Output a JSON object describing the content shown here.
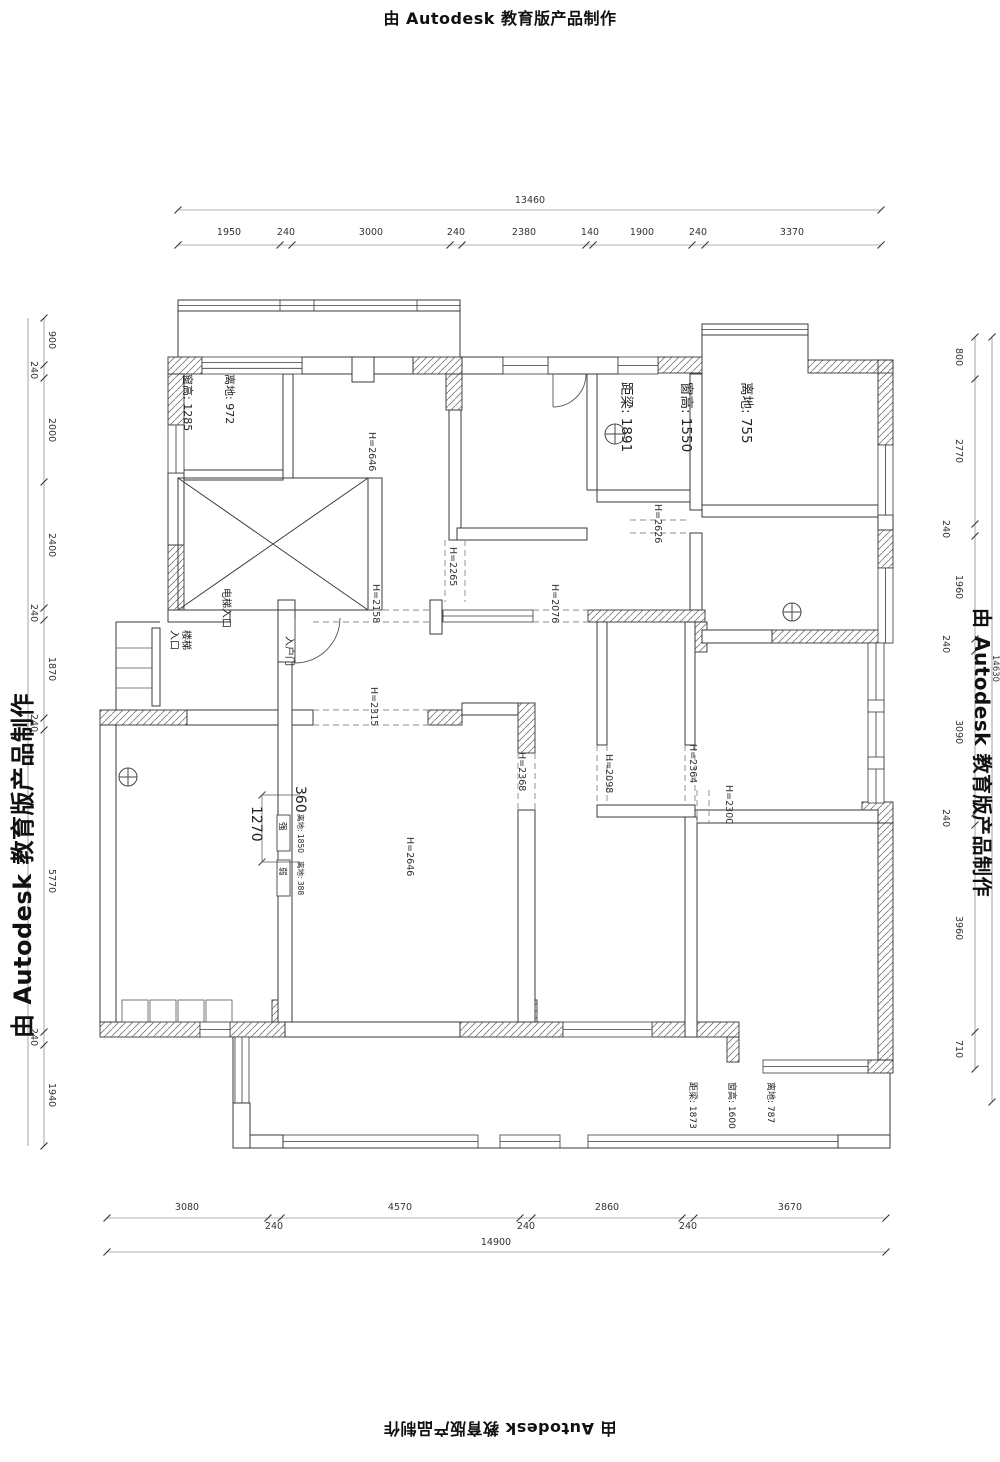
{
  "watermark": {
    "text": "由 Autodesk 教育版产品制作"
  },
  "dims": {
    "top": {
      "total": "13460",
      "segments": [
        "1950",
        "240",
        "3000",
        "240",
        "2380",
        "140",
        "1900",
        "240",
        "3370"
      ]
    },
    "bottom": {
      "total": "14900",
      "row1": [
        "3080",
        "4570",
        "2860",
        "3670"
      ],
      "row2": [
        "240",
        "240",
        "240"
      ]
    },
    "left": {
      "segments": [
        "900",
        "240",
        "2000",
        "2400",
        "240",
        "1870",
        "240",
        "5770",
        "240",
        "1940"
      ]
    },
    "right": {
      "total": "14630",
      "segments": [
        "800",
        "2770",
        "240",
        "1960",
        "240",
        "3090",
        "240",
        "3960",
        "710"
      ]
    },
    "wall_dim_360": "360",
    "wall_dim_1270": "1270"
  },
  "heights": {
    "top_room": "H=2646",
    "h2265": "H=2265",
    "h2158": "H=2158",
    "h2626": "H=2626",
    "h2076": "H=2076",
    "h2315": "H=2315",
    "h2368": "H=2368",
    "h2098": "H=2098",
    "h2364": "H=2364",
    "h2300": "H=2300",
    "living_room": "H=2646"
  },
  "annotations": {
    "window_nw": {
      "l1": "离地: 972",
      "l2": "窗高: 1285"
    },
    "window_ne": {
      "l1": "离地: 755",
      "l2": "窗高: 1550",
      "l3": "距梁: 1891"
    },
    "window_se": {
      "l1": "离地: 787",
      "l2": "窗高: 1600",
      "l3": "距梁: 1873"
    },
    "elevator_entry": "电梯入口",
    "stair_entry": "楼梯\n入口",
    "entry_door": "入户门",
    "strong_box": {
      "label": "强",
      "note": "离地: 1850"
    },
    "weak_box": {
      "label": "弱",
      "note": "离地: 388"
    }
  }
}
